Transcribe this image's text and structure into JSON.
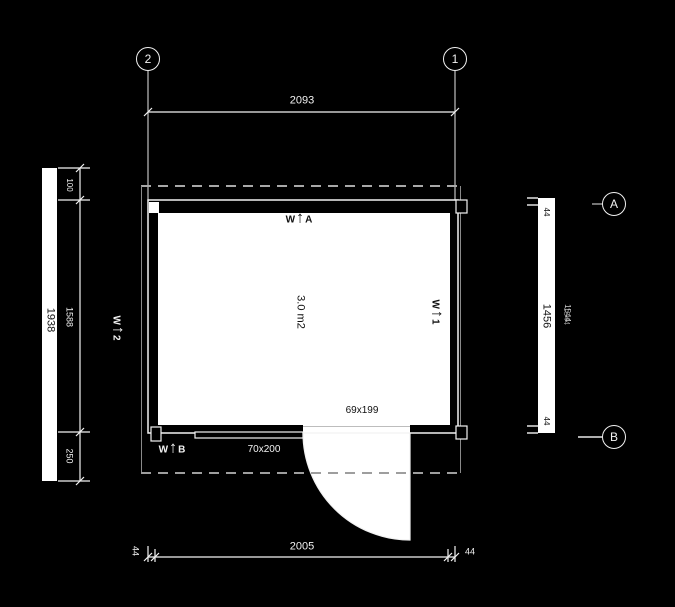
{
  "drawing": {
    "title": "floor plan",
    "grid": {
      "col_left": "2",
      "col_right": "1",
      "row_top": "A",
      "row_bottom": "B"
    },
    "dims": {
      "top_width": "2093",
      "bottom_width": "2005",
      "bottom_left_end": "44",
      "bottom_right_end": "44",
      "left_total": "1938",
      "left_top": "100",
      "left_mid": "1588",
      "left_bottom": "250",
      "right_total": "1456",
      "right_top": "44",
      "right_bottom": "44",
      "right_overall": "1544"
    },
    "room": {
      "area": "3.0 m2",
      "door_size": "69x199",
      "window_size": "70x200"
    },
    "markers": {
      "top": {
        "prefix": "W",
        "arrow": "↑",
        "suffix": "A"
      },
      "right": {
        "prefix": "W",
        "arrow": "↑",
        "suffix": "1"
      },
      "left": {
        "prefix": "W",
        "arrow": "↑",
        "suffix": "2"
      },
      "bottom": {
        "prefix": "W",
        "arrow": "↑",
        "suffix": "B"
      }
    },
    "colors": {
      "background": "#000000",
      "line": "#f2f2f2",
      "dashed": "#9e9e9e",
      "interior": "#ffffff",
      "text_dark": "#101010"
    }
  }
}
